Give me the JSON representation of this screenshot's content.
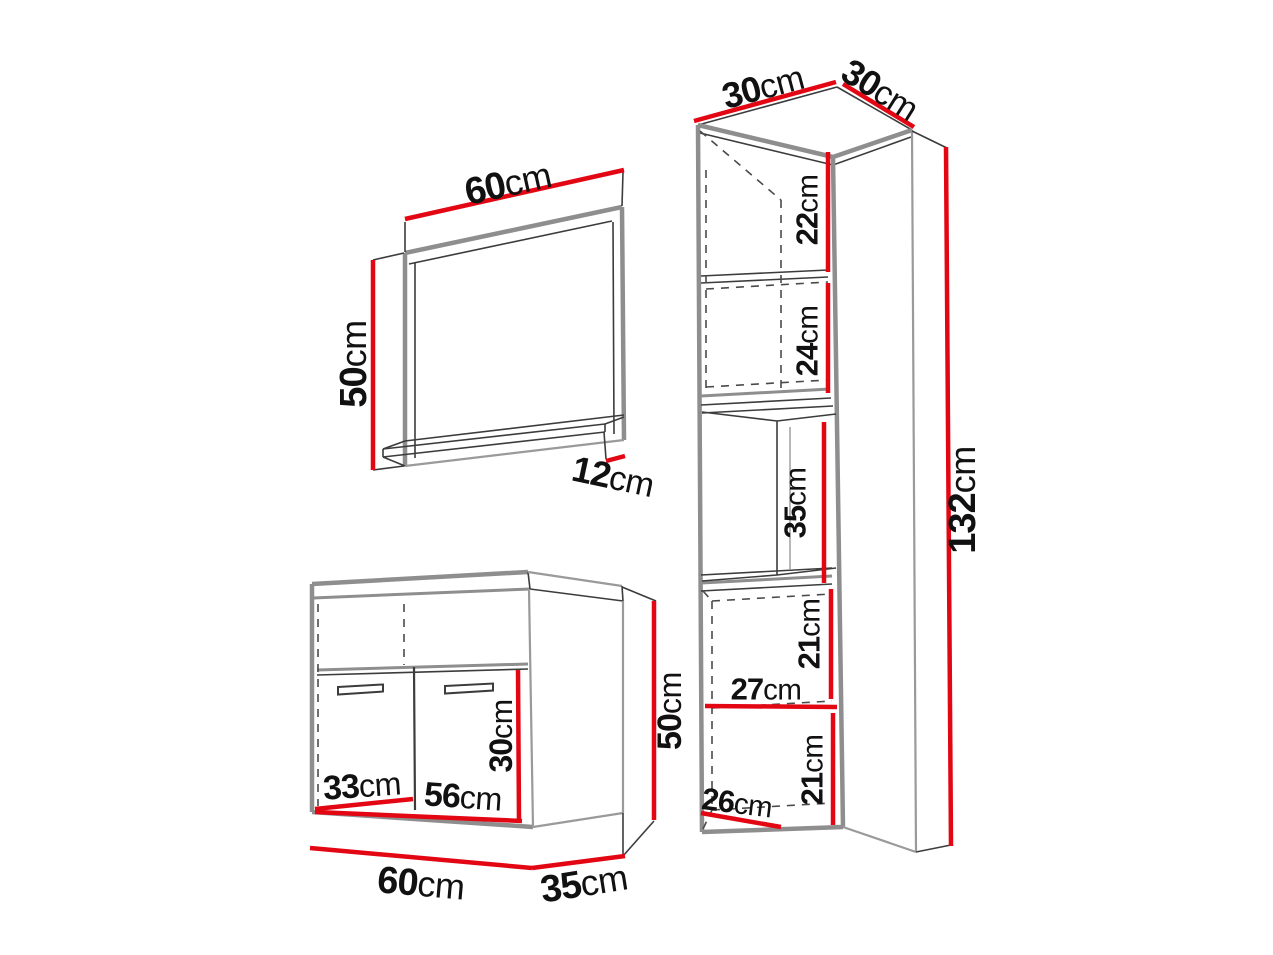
{
  "title": "Bathroom furniture set dimension diagram",
  "colors": {
    "background": "#ffffff",
    "dimension_line": "#e30613",
    "furniture_outline": "#8e8e8e",
    "detail_line": "#3c3c3c",
    "label_text": "#111111"
  },
  "pieces": {
    "mirror": {
      "name": "wall mirror with shelf",
      "dims": {
        "width": {
          "value": "60",
          "unit": "cm"
        },
        "height": {
          "value": "50",
          "unit": "cm"
        },
        "shelf_depth": {
          "value": "12",
          "unit": "cm"
        }
      }
    },
    "vanity": {
      "name": "sink vanity cabinet",
      "dims": {
        "width": {
          "value": "60",
          "unit": "cm"
        },
        "depth": {
          "value": "35",
          "unit": "cm"
        },
        "height": {
          "value": "50",
          "unit": "cm"
        },
        "door_width": {
          "value": "33",
          "unit": "cm"
        },
        "inner_width": {
          "value": "56",
          "unit": "cm"
        },
        "inner_height": {
          "value": "30",
          "unit": "cm"
        }
      }
    },
    "tall_cabinet": {
      "name": "tall storage cabinet",
      "dims": {
        "width": {
          "value": "30",
          "unit": "cm"
        },
        "depth": {
          "value": "30",
          "unit": "cm"
        },
        "height": {
          "value": "132",
          "unit": "cm"
        },
        "top_section": {
          "value": "22",
          "unit": "cm"
        },
        "second_section": {
          "value": "24",
          "unit": "cm"
        },
        "open_niche": {
          "value": "35",
          "unit": "cm"
        },
        "fourth_section": {
          "value": "21",
          "unit": "cm"
        },
        "inner_width": {
          "value": "27",
          "unit": "cm"
        },
        "fifth_section": {
          "value": "21",
          "unit": "cm"
        },
        "bottom_inner_width": {
          "value": "26",
          "unit": "cm"
        }
      }
    }
  }
}
